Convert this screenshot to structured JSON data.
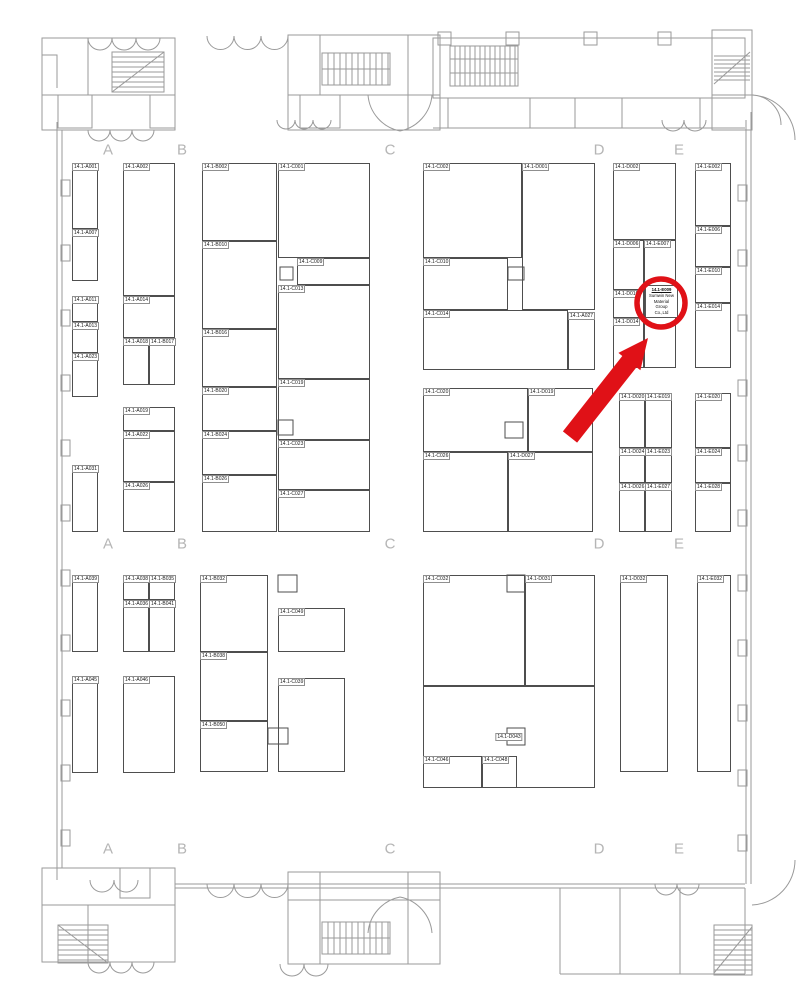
{
  "colors": {
    "highlight_red": "#e01117",
    "wall_gray": "#9a9a9a",
    "booth_line": "#4e4e4e",
    "grid_letter_gray": "#b5b5b5"
  },
  "floorplan": {
    "grid_letters": [
      {
        "label": "A",
        "x": 108,
        "y": 150
      },
      {
        "label": "B",
        "x": 182,
        "y": 150
      },
      {
        "label": "C",
        "x": 390,
        "y": 150
      },
      {
        "label": "D",
        "x": 599,
        "y": 150
      },
      {
        "label": "E",
        "x": 679,
        "y": 150
      },
      {
        "label": "A",
        "x": 108,
        "y": 544
      },
      {
        "label": "B",
        "x": 182,
        "y": 544
      },
      {
        "label": "C",
        "x": 390,
        "y": 544
      },
      {
        "label": "D",
        "x": 599,
        "y": 544
      },
      {
        "label": "E",
        "x": 679,
        "y": 544
      },
      {
        "label": "A",
        "x": 108,
        "y": 849
      },
      {
        "label": "B",
        "x": 182,
        "y": 849
      },
      {
        "label": "C",
        "x": 390,
        "y": 849
      },
      {
        "label": "D",
        "x": 599,
        "y": 849
      },
      {
        "label": "E",
        "x": 679,
        "y": 849
      }
    ],
    "highlight": {
      "lines": [
        "14.1-E009",
        "Sumwin New",
        "Material",
        "Group",
        "Co.,Ltd"
      ]
    },
    "booths": [
      {
        "label": "14.1-A001",
        "x": 72,
        "y": 163,
        "w": 26,
        "h": 66
      },
      {
        "label": "14.1-A007",
        "x": 72,
        "y": 229,
        "w": 26,
        "h": 52
      },
      {
        "label": "14.1-A011",
        "x": 72,
        "y": 296,
        "w": 26,
        "h": 26
      },
      {
        "label": "14.1-A013",
        "x": 72,
        "y": 322,
        "w": 26,
        "h": 31
      },
      {
        "label": "14.1-A023",
        "x": 72,
        "y": 353,
        "w": 26,
        "h": 44
      },
      {
        "label": "14.1-A031",
        "x": 72,
        "y": 465,
        "w": 26,
        "h": 67
      },
      {
        "label": "14.1-A002",
        "x": 123,
        "y": 163,
        "w": 52,
        "h": 133
      },
      {
        "label": "14.1-A014",
        "x": 123,
        "y": 296,
        "w": 52,
        "h": 42
      },
      {
        "label": "14.1-A018",
        "x": 123,
        "y": 338,
        "w": 26,
        "h": 47
      },
      {
        "label": "14.1-B017",
        "x": 149,
        "y": 338,
        "w": 26,
        "h": 47
      },
      {
        "label": "14.1-A019",
        "x": 123,
        "y": 407,
        "w": 52,
        "h": 24
      },
      {
        "label": "14.1-A022",
        "x": 123,
        "y": 431,
        "w": 52,
        "h": 51
      },
      {
        "label": "14.1-A026",
        "x": 123,
        "y": 482,
        "w": 52,
        "h": 50
      },
      {
        "label": "14.1-B002",
        "x": 202,
        "y": 163,
        "w": 75,
        "h": 78
      },
      {
        "label": "14.1-B010",
        "x": 202,
        "y": 241,
        "w": 75,
        "h": 88
      },
      {
        "label": "14.1-B016",
        "x": 202,
        "y": 329,
        "w": 75,
        "h": 58
      },
      {
        "label": "14.1-B020",
        "x": 202,
        "y": 387,
        "w": 75,
        "h": 44
      },
      {
        "label": "14.1-B024",
        "x": 202,
        "y": 431,
        "w": 75,
        "h": 44
      },
      {
        "label": "14.1-B026",
        "x": 202,
        "y": 475,
        "w": 75,
        "h": 57
      },
      {
        "label": "14.1-C001",
        "x": 278,
        "y": 163,
        "w": 92,
        "h": 95
      },
      {
        "label": "14.1-C009",
        "x": 297,
        "y": 258,
        "w": 73,
        "h": 27
      },
      {
        "label": "14.1-C013",
        "x": 278,
        "y": 285,
        "w": 92,
        "h": 94
      },
      {
        "label": "14.1-C019",
        "x": 278,
        "y": 379,
        "w": 92,
        "h": 61
      },
      {
        "label": "14.1-C023",
        "x": 278,
        "y": 440,
        "w": 92,
        "h": 50
      },
      {
        "label": "14.1-C027",
        "x": 278,
        "y": 490,
        "w": 92,
        "h": 42
      },
      {
        "label": "14.1-C002",
        "x": 423,
        "y": 163,
        "w": 99,
        "h": 95
      },
      {
        "label": "14.1-D001",
        "x": 522,
        "y": 163,
        "w": 73,
        "h": 147
      },
      {
        "label": "14.1-C010",
        "x": 423,
        "y": 258,
        "w": 85,
        "h": 52
      },
      {
        "label": "14.1-C014",
        "x": 423,
        "y": 310,
        "w": 145,
        "h": 60
      },
      {
        "label": "14.1-A027",
        "x": 568,
        "y": 312,
        "w": 27,
        "h": 58
      },
      {
        "label": "14.1-C020",
        "x": 423,
        "y": 388,
        "w": 105,
        "h": 64
      },
      {
        "label": "14.1-D019",
        "x": 528,
        "y": 388,
        "w": 65,
        "h": 64
      },
      {
        "label": "14.1-C026",
        "x": 423,
        "y": 452,
        "w": 85,
        "h": 80
      },
      {
        "label": "14.1-D027",
        "x": 508,
        "y": 452,
        "w": 85,
        "h": 80
      },
      {
        "label": "14.1-D002",
        "x": 613,
        "y": 163,
        "w": 63,
        "h": 77
      },
      {
        "label": "14.1-D006",
        "x": 613,
        "y": 240,
        "w": 31,
        "h": 50
      },
      {
        "label": "14.1-E007",
        "x": 644,
        "y": 240,
        "w": 32,
        "h": 50
      },
      {
        "label": "14.1-D010",
        "x": 613,
        "y": 290,
        "w": 31,
        "h": 28
      },
      {
        "label": "",
        "x": 644,
        "y": 290,
        "w": 32,
        "h": 78,
        "highlighted": true
      },
      {
        "label": "14.1-D014",
        "x": 613,
        "y": 318,
        "w": 31,
        "h": 50
      },
      {
        "label": "14.1-E002",
        "x": 695,
        "y": 163,
        "w": 36,
        "h": 63
      },
      {
        "label": "14.1-E006",
        "x": 695,
        "y": 226,
        "w": 36,
        "h": 41
      },
      {
        "label": "14.1-E010",
        "x": 695,
        "y": 267,
        "w": 36,
        "h": 36
      },
      {
        "label": "14.1-E014",
        "x": 695,
        "y": 303,
        "w": 36,
        "h": 65
      },
      {
        "label": "14.1-D020",
        "x": 619,
        "y": 393,
        "w": 26,
        "h": 55
      },
      {
        "label": "14.1-E019",
        "x": 645,
        "y": 393,
        "w": 27,
        "h": 55
      },
      {
        "label": "14.1-D024",
        "x": 619,
        "y": 448,
        "w": 26,
        "h": 35
      },
      {
        "label": "14.1-E023",
        "x": 645,
        "y": 448,
        "w": 27,
        "h": 35
      },
      {
        "label": "14.1-D026",
        "x": 619,
        "y": 483,
        "w": 26,
        "h": 49
      },
      {
        "label": "14.1-E027",
        "x": 645,
        "y": 483,
        "w": 27,
        "h": 49
      },
      {
        "label": "14.1-E020",
        "x": 695,
        "y": 393,
        "w": 36,
        "h": 55
      },
      {
        "label": "14.1-E024",
        "x": 695,
        "y": 448,
        "w": 36,
        "h": 35
      },
      {
        "label": "14.1-E028",
        "x": 695,
        "y": 483,
        "w": 36,
        "h": 49
      },
      {
        "label": "14.1-A039",
        "x": 72,
        "y": 575,
        "w": 26,
        "h": 77
      },
      {
        "label": "14.1-A045",
        "x": 72,
        "y": 676,
        "w": 26,
        "h": 97
      },
      {
        "label": "14.1-A038",
        "x": 123,
        "y": 575,
        "w": 26,
        "h": 25
      },
      {
        "label": "14.1-B035",
        "x": 149,
        "y": 575,
        "w": 26,
        "h": 25
      },
      {
        "label": "14.1-A036",
        "x": 123,
        "y": 600,
        "w": 26,
        "h": 52
      },
      {
        "label": "14.1-B041",
        "x": 149,
        "y": 600,
        "w": 26,
        "h": 52
      },
      {
        "label": "14.1-A046",
        "x": 123,
        "y": 676,
        "w": 52,
        "h": 97
      },
      {
        "label": "14.1-B032",
        "x": 200,
        "y": 575,
        "w": 68,
        "h": 77
      },
      {
        "label": "14.1-B038",
        "x": 200,
        "y": 652,
        "w": 68,
        "h": 69
      },
      {
        "label": "14.1-B050",
        "x": 200,
        "y": 721,
        "w": 68,
        "h": 51
      },
      {
        "label": "14.1-C049",
        "x": 278,
        "y": 608,
        "w": 67,
        "h": 44
      },
      {
        "label": "14.1-C039",
        "x": 278,
        "y": 678,
        "w": 67,
        "h": 94
      },
      {
        "label": "14.1-C032",
        "x": 423,
        "y": 575,
        "w": 102,
        "h": 111
      },
      {
        "label": "14.1-D031",
        "x": 525,
        "y": 575,
        "w": 70,
        "h": 111
      },
      {
        "label": "14.1-D043",
        "x": 423,
        "y": 686,
        "w": 172,
        "h": 102,
        "center": true
      },
      {
        "label": "14.1-C046",
        "x": 423,
        "y": 756,
        "w": 59,
        "h": 32
      },
      {
        "label": "14.1-C048",
        "x": 482,
        "y": 756,
        "w": 35,
        "h": 32
      },
      {
        "label": "14.1-D032",
        "x": 620,
        "y": 575,
        "w": 48,
        "h": 197
      },
      {
        "label": "14.1-E032",
        "x": 697,
        "y": 575,
        "w": 34,
        "h": 197
      }
    ]
  }
}
